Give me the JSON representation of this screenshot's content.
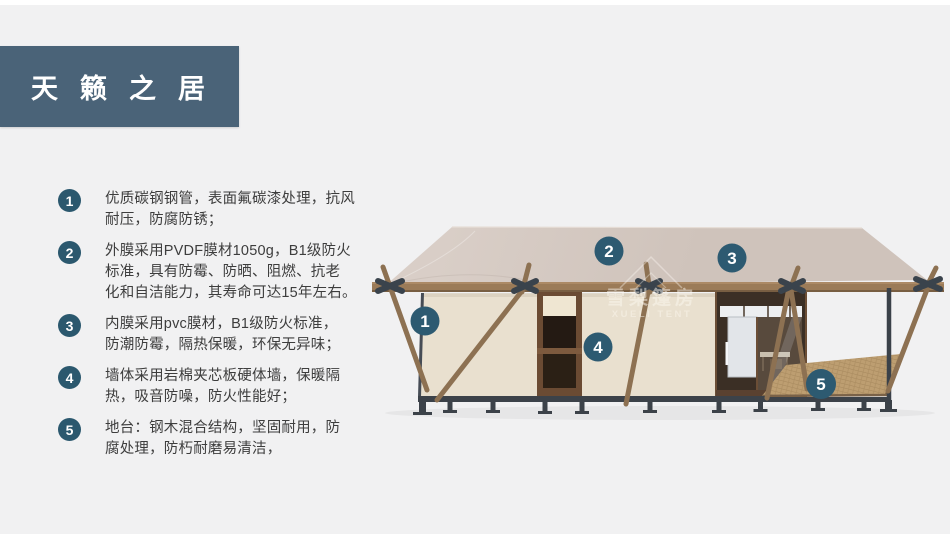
{
  "title": {
    "text": "天籁之居"
  },
  "features": [
    {
      "num": "1",
      "lines": [
        "优质碳钢钢管，表面氟碳漆处理，抗风",
        "耐压，防腐防锈；"
      ]
    },
    {
      "num": "2",
      "lines": [
        "外膜采用PVDF膜材1050g，B1级防火",
        "标准，具有防霉、防晒、阻燃、抗老",
        "化和自洁能力，其寿命可达15年左右。"
      ]
    },
    {
      "num": "3",
      "lines": [
        "内膜采用pvc膜材，B1级防火标准，",
        "防潮防霉，隔热保暖，环保无异味；"
      ]
    },
    {
      "num": "4",
      "lines": [
        "墙体采用岩棉夹芯板硬体墙，保暖隔",
        "热，吸音防噪，防火性能好；"
      ]
    },
    {
      "num": "5",
      "lines": [
        "地台：钢木混合结构，坚固耐用，防",
        "腐处理，防朽耐磨易清洁，"
      ]
    }
  ],
  "markers": [
    {
      "label": "1"
    },
    {
      "label": "2"
    },
    {
      "label": "3"
    },
    {
      "label": "4"
    },
    {
      "label": "5"
    }
  ],
  "watermark": {
    "line1": "雪梨篷房",
    "line2": "XUELI TENT"
  },
  "colors": {
    "accent_circle": "#2b586e",
    "title_bg": "#4a6378",
    "roof": "#d2c6bf",
    "wall": "#e9e0cf",
    "wood": "#8d7152",
    "steel": "#3c4249",
    "background": "#f1f1f2"
  }
}
